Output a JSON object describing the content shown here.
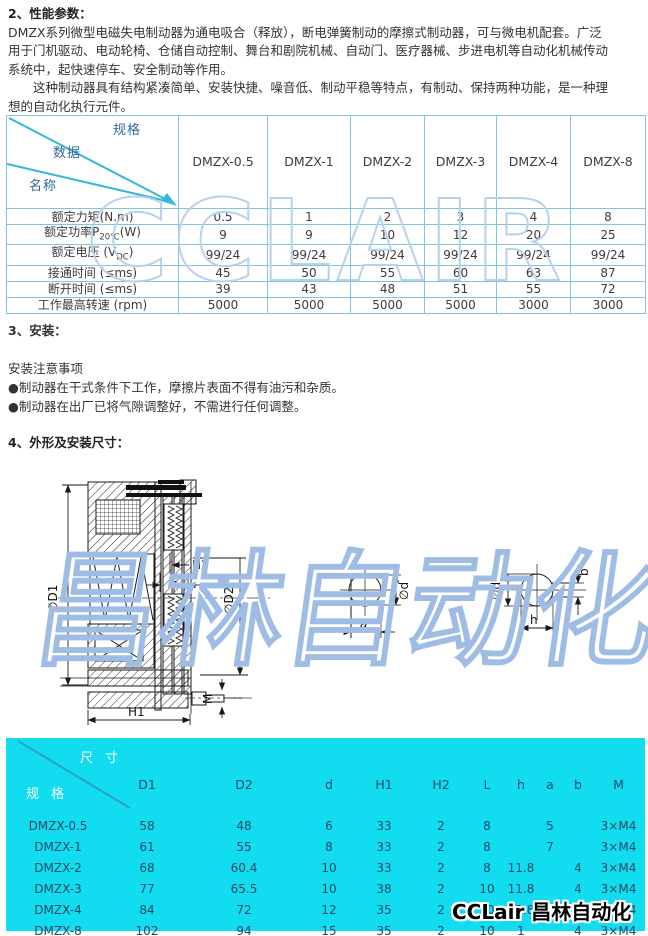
{
  "colors": {
    "accent_cyan": "#12dcf0",
    "table_border": "#86c3de",
    "diagonal_cyan": "#35b7d6",
    "navy_text": "#1d4a63",
    "watermark_blue": "#b7d2ec"
  },
  "intro": {
    "title": "2、性能参数：",
    "lines": [
      "DMZX系列微型电磁失电制动器为通电吸合（释放），断电弹簧制动的摩擦式制动器，可与微电机配套。广泛",
      "用于门机驱动、电动轮椅、仓储自动控制、舞台和剧院机械、自动门、医疗器械、步进电机等自动化机械传动",
      "系统中，起快速停车、安全制动等作用。",
      "　　这种制动器具有结构紧凑简单、安装快捷、噪音低、制动平稳等特点，有制动、保持两种功能，是一种理",
      "想的自动化执行元件。"
    ]
  },
  "install": {
    "title": "3、安装：",
    "subtitle": "安装注意事项",
    "notes": [
      "●制动器在干式条件下工作，摩擦片表面不得有油污和杂质。",
      "●制动器在出厂已将气隙调整好，不需进行任何调整。"
    ]
  },
  "dims_section": {
    "title": "4、外形及安装尺寸："
  },
  "perf_table": {
    "corner": {
      "spec": "规格",
      "data": "数据",
      "name": "名称"
    },
    "models": [
      "DMZX-0.5",
      "DMZX-1",
      "DMZX-2",
      "DMZX-3",
      "DMZX-4",
      "DMZX-8"
    ],
    "rows": [
      {
        "pre": "额定力矩(N.m)",
        "sub": "",
        "post": "",
        "values": [
          "0.5",
          "1",
          "2",
          "3",
          "4",
          "8"
        ]
      },
      {
        "pre": "额定功率P",
        "sub": "20℃",
        "post": "(W)",
        "values": [
          "9",
          "9",
          "10",
          "12",
          "20",
          "25"
        ]
      },
      {
        "pre": "额定电压 (V",
        "sub": "DC",
        "post": ")",
        "values": [
          "99/24",
          "99/24",
          "99/24",
          "99/24",
          "99/24",
          "99/24"
        ]
      },
      {
        "pre": "接通时间 (≤ms)",
        "sub": "",
        "post": "",
        "values": [
          "45",
          "50",
          "55",
          "60",
          "63",
          "87"
        ]
      },
      {
        "pre": "断开时间 (≤ms)",
        "sub": "",
        "post": "",
        "values": [
          "39",
          "43",
          "48",
          "51",
          "55",
          "72"
        ]
      },
      {
        "pre": "工作最高转速 (rpm)",
        "sub": "",
        "post": "",
        "values": [
          "5000",
          "5000",
          "5000",
          "5000",
          "3000",
          "3000"
        ]
      }
    ]
  },
  "spec_table": {
    "corner": {
      "dim": "尺 寸",
      "spec": "规 格"
    },
    "columns": [
      "D1",
      "D2",
      "d",
      "H1",
      "H2",
      "L",
      "h",
      "a",
      "b",
      "M"
    ],
    "rows": [
      {
        "name": "DMZX-0.5",
        "values": [
          "58",
          "48",
          "6",
          "33",
          "2",
          "8",
          "",
          "5",
          "",
          "3×M4"
        ]
      },
      {
        "name": "DMZX-1",
        "values": [
          "61",
          "55",
          "8",
          "33",
          "2",
          "8",
          "",
          "7",
          "",
          "3×M4"
        ]
      },
      {
        "name": "DMZX-2",
        "values": [
          "68",
          "60.4",
          "10",
          "33",
          "2",
          "8",
          "11.8",
          "",
          "4",
          "3×M4"
        ]
      },
      {
        "name": "DMZX-3",
        "values": [
          "77",
          "65.5",
          "10",
          "38",
          "2",
          "10",
          "11.8",
          "",
          "4",
          "3×M4"
        ]
      },
      {
        "name": "DMZX-4",
        "values": [
          "84",
          "72",
          "12",
          "35",
          "2",
          "10",
          "13.8",
          "",
          "4",
          "3×M4"
        ]
      },
      {
        "name": "DMZX-8",
        "values": [
          "102",
          "94",
          "15",
          "35",
          "2",
          "10",
          "1",
          "",
          "4",
          "3×M4"
        ]
      }
    ]
  },
  "drawing": {
    "labels": {
      "d1": "∅D1",
      "d2": "∅D2",
      "h1": "H1",
      "h2": "H2",
      "l": "L",
      "m": "M",
      "d_small_a": "∅d",
      "a": "a",
      "d_small_b": "∅d",
      "b": "b",
      "h": "h"
    }
  },
  "watermarks": {
    "table": "CCLAIR",
    "drawing": "昌林自动化",
    "logo": "CCLair 昌林自动化"
  }
}
